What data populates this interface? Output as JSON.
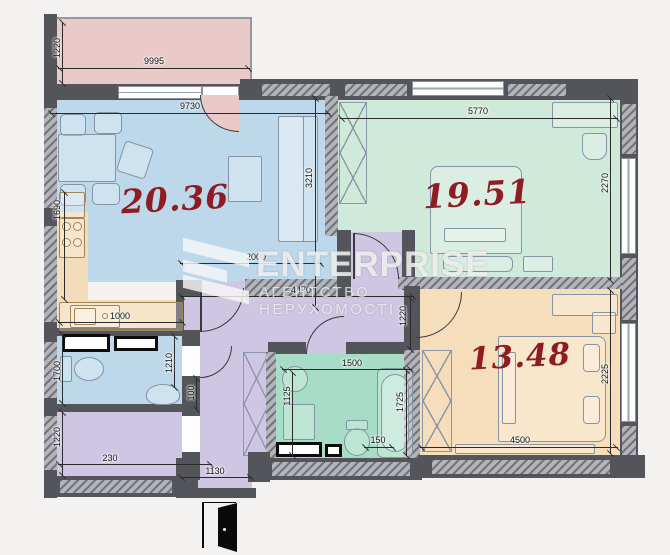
{
  "watermark": {
    "brand": "ENTERPRISE",
    "subtitle": "АГЕНТСТВО НЕРУХОМОСТІ",
    "logo_icon": "chevron-e-logo"
  },
  "rooms": {
    "living": {
      "area": "20.36"
    },
    "bedroom1": {
      "area": "19.51"
    },
    "bedroom2": {
      "area": "13.48"
    }
  },
  "dimensions": {
    "balcony_width": "9995",
    "balcony_depth": "1220",
    "living_width": "9730",
    "living_depth": "3210",
    "living_span": "2000",
    "kitchen_side": "1690",
    "kitchen_width": "1000",
    "bedroom1_width": "5770",
    "bedroom1_depth": "2270",
    "hall_width": "4470",
    "hall_depth": "1220",
    "wc_depth": "1700",
    "wc_width": "1210",
    "wall_gap": "100",
    "storage_depth": "1220",
    "storage_width": "230",
    "entry_width": "1130",
    "bath_width": "1500",
    "bath_depth": "1125",
    "bath_length": "1725",
    "bath_gap": "150",
    "bedroom2_width": "4500",
    "bedroom2_depth": "2225"
  },
  "colors": {
    "balcony": "#eac9c9",
    "living": "#bed8eb",
    "bedroom1": "#cfe9da",
    "bathroom": "#a7dcc6",
    "bedroom2": "#f6debd",
    "hall": "#cfc6e3",
    "wall": "#54555b",
    "area_label": "#8e1c22"
  }
}
